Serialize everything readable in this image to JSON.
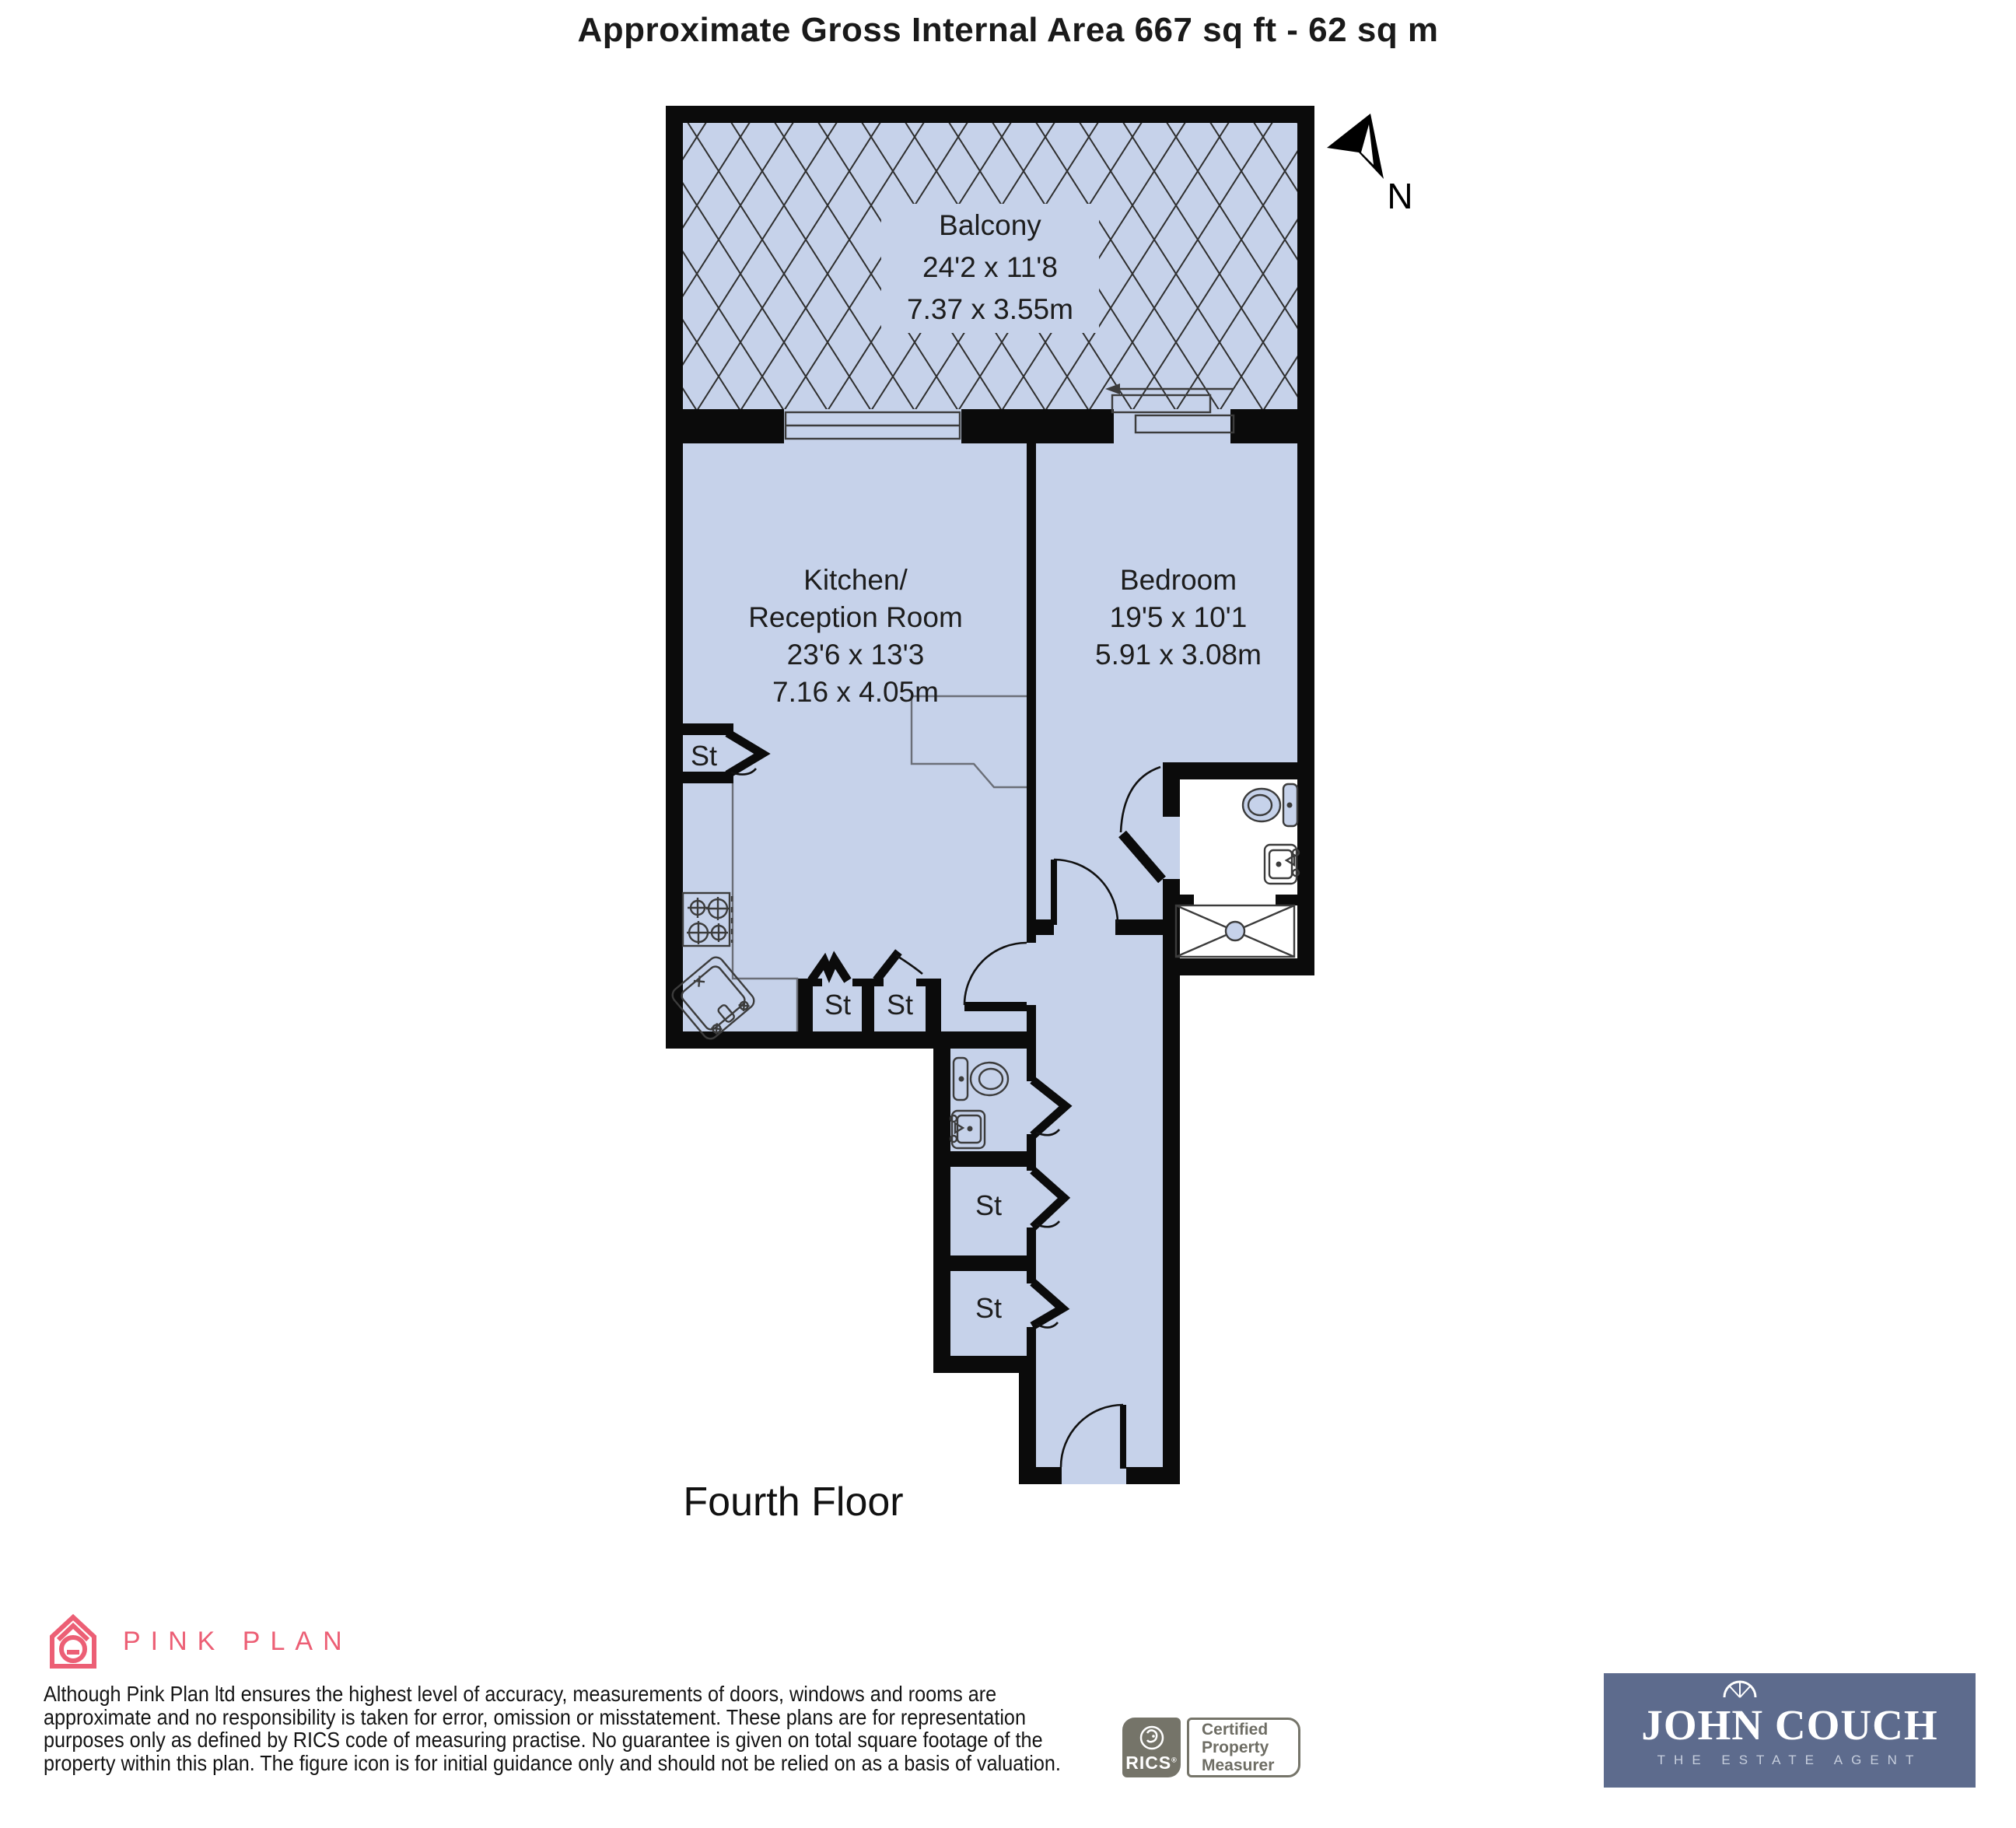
{
  "title": "Approximate Gross Internal Area 667 sq ft - 62 sq m",
  "plan": {
    "floor_label": "Fourth Floor",
    "north_label": "N",
    "storage_label": "St",
    "rooms": {
      "balcony": {
        "name": "Balcony",
        "dim_imperial": "24'2 x 11'8",
        "dim_metric": "7.37 x 3.55m"
      },
      "kitchen": {
        "name_line1": "Kitchen/",
        "name_line2": "Reception Room",
        "dim_imperial": "23'6 x 13'3",
        "dim_metric": "7.16 x 4.05m"
      },
      "bedroom": {
        "name": "Bedroom",
        "dim_imperial": "19'5 x 10'1",
        "dim_metric": "5.91 x 3.08m"
      }
    },
    "icons": [
      "north-arrow-icon",
      "toilet-icon",
      "sink-icon",
      "shower-icon",
      "hob-icon",
      "kitchen-sink-icon",
      "door-arc"
    ]
  },
  "footer": {
    "pink_plan_brand": "PINK PLAN",
    "disclaimer_lines": [
      "Although Pink Plan ltd ensures the highest level of accuracy, measurements of doors, windows and rooms are",
      "approximate and no responsibility is taken for error, omission or misstatement. These plans are for representation",
      "purposes only as defined by RICS code of measuring practise. No guarantee is given on total square footage of the",
      "property within this plan. The figure icon is for initial guidance only and should not be relied on as a basis of valuation."
    ],
    "rics": {
      "brand": "RICS",
      "reg": "®",
      "lines": [
        "Certified",
        "Property",
        "Measurer"
      ]
    },
    "agent": {
      "name": "JOHN COUCH",
      "tagline": "THE ESTATE AGENT"
    }
  },
  "colors": {
    "room_fill": "#c6d2ea",
    "wall": "#0b0b0b",
    "pink": "#ec5f75",
    "slate_blue": "#5d6b8d",
    "badge_gray": "#757469"
  }
}
